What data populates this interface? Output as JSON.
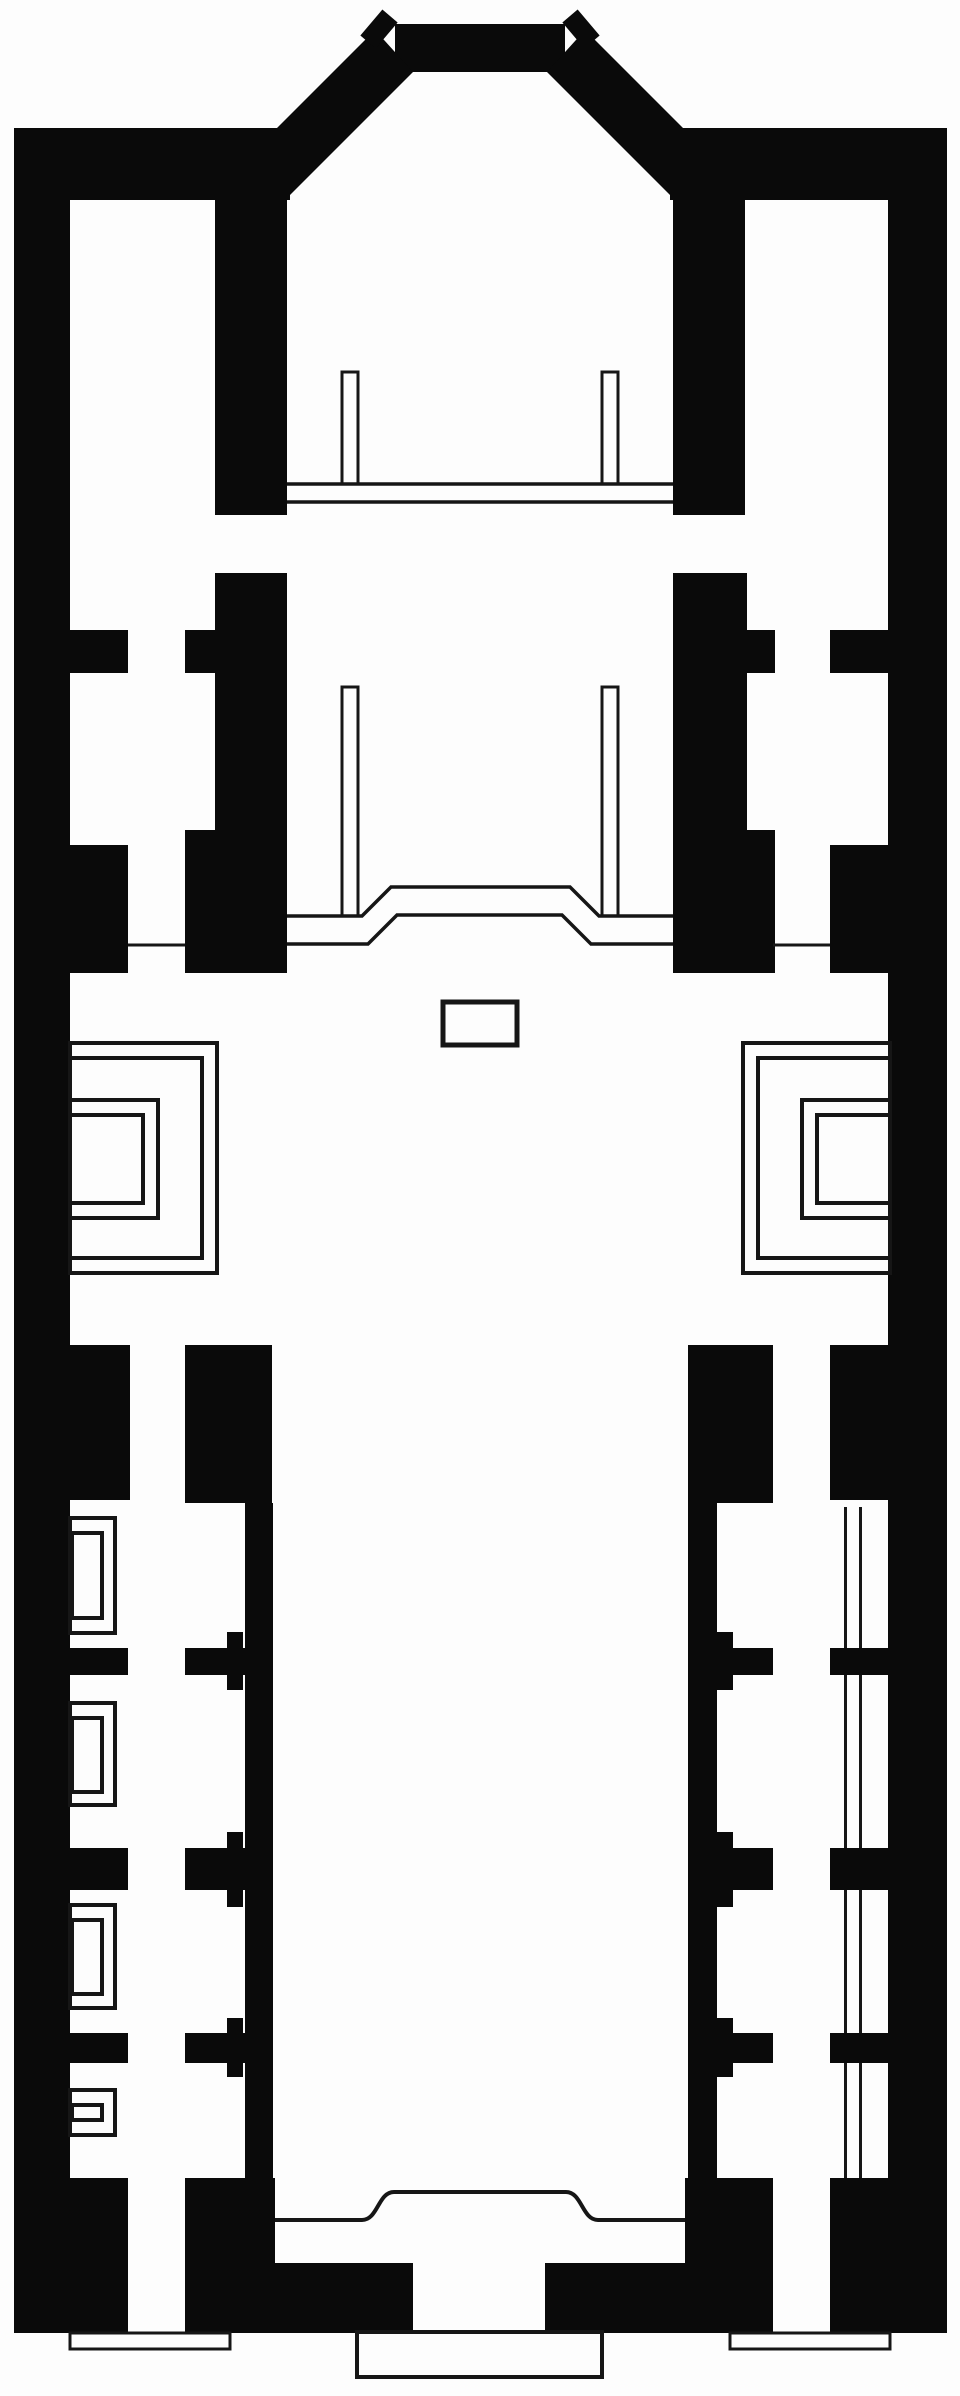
{
  "meta": {
    "description": "church-floor-plan",
    "canvas": {
      "width": 960,
      "height": 2396
    }
  },
  "palette": {
    "paper": "#fdfdfd",
    "ink": "#0a0a0a",
    "line": "#161616"
  },
  "plan": {
    "walls": [
      {
        "name": "outer-wall-left",
        "x": 14,
        "y": 128,
        "w": 56,
        "h": 2205
      },
      {
        "name": "outer-wall-right",
        "x": 888,
        "y": 128,
        "w": 59,
        "h": 2050
      },
      {
        "name": "apse-side-band-left",
        "x": 14,
        "y": 128,
        "w": 276,
        "h": 72
      },
      {
        "name": "apse-side-band-right",
        "x": 670,
        "y": 128,
        "w": 277,
        "h": 72
      },
      {
        "name": "apse-top-bar",
        "x": 395,
        "y": 24,
        "w": 170,
        "h": 48
      },
      {
        "name": "chancel-wall-left",
        "x": 215,
        "y": 200,
        "w": 72,
        "h": 315
      },
      {
        "name": "chancel-wall-right",
        "x": 673,
        "y": 200,
        "w": 72,
        "h": 315
      },
      {
        "name": "choir-wall-left",
        "x": 215,
        "y": 573,
        "w": 72,
        "h": 400
      },
      {
        "name": "choir-wall-right",
        "x": 673,
        "y": 573,
        "w": 74,
        "h": 400
      },
      {
        "name": "choir-spur-left-upper",
        "x": 185,
        "y": 630,
        "w": 30,
        "h": 43
      },
      {
        "name": "choir-spur-left-lower",
        "x": 185,
        "y": 830,
        "w": 30,
        "h": 143
      },
      {
        "name": "choir-spur-right-upper",
        "x": 747,
        "y": 630,
        "w": 28,
        "h": 43
      },
      {
        "name": "choir-spur-right-lower",
        "x": 747,
        "y": 830,
        "w": 28,
        "h": 143
      },
      {
        "name": "aisle-stub-left-upper",
        "x": 70,
        "y": 630,
        "w": 58,
        "h": 43
      },
      {
        "name": "aisle-block-left",
        "x": 70,
        "y": 845,
        "w": 58,
        "h": 128
      },
      {
        "name": "aisle-stub-right-upper",
        "x": 830,
        "y": 630,
        "w": 58,
        "h": 43
      },
      {
        "name": "aisle-block-right",
        "x": 830,
        "y": 845,
        "w": 58,
        "h": 128
      },
      {
        "name": "crossing-pier-left-outer",
        "x": 70,
        "y": 1345,
        "w": 60,
        "h": 155
      },
      {
        "name": "crossing-pier-left-inner",
        "x": 185,
        "y": 1345,
        "w": 87,
        "h": 158
      },
      {
        "name": "crossing-pier-right-inner",
        "x": 688,
        "y": 1345,
        "w": 85,
        "h": 158
      },
      {
        "name": "crossing-pier-right-outer",
        "x": 830,
        "y": 1345,
        "w": 58,
        "h": 155
      },
      {
        "name": "nave-wall-left",
        "x": 245,
        "y": 1503,
        "w": 28,
        "h": 675
      },
      {
        "name": "nave-wall-right",
        "x": 688,
        "y": 1503,
        "w": 29,
        "h": 675
      },
      {
        "name": "nave-stub-left-1",
        "x": 185,
        "y": 1648,
        "w": 88,
        "h": 27
      },
      {
        "name": "nave-stub-left-2",
        "x": 185,
        "y": 1848,
        "w": 88,
        "h": 42
      },
      {
        "name": "nave-stub-left-3",
        "x": 185,
        "y": 2033,
        "w": 88,
        "h": 30
      },
      {
        "name": "nave-notch-left-1a",
        "x": 227,
        "y": 1632,
        "w": 16,
        "h": 16
      },
      {
        "name": "nave-notch-left-1b",
        "x": 227,
        "y": 1675,
        "w": 16,
        "h": 15
      },
      {
        "name": "nave-notch-left-2a",
        "x": 227,
        "y": 1832,
        "w": 16,
        "h": 16
      },
      {
        "name": "nave-notch-left-2b",
        "x": 227,
        "y": 1890,
        "w": 16,
        "h": 17
      },
      {
        "name": "nave-notch-left-3a",
        "x": 227,
        "y": 2018,
        "w": 16,
        "h": 15
      },
      {
        "name": "nave-notch-left-3b",
        "x": 227,
        "y": 2063,
        "w": 16,
        "h": 14
      },
      {
        "name": "nave-stub-right-1",
        "x": 688,
        "y": 1648,
        "w": 85,
        "h": 27
      },
      {
        "name": "nave-stub-right-2",
        "x": 688,
        "y": 1848,
        "w": 85,
        "h": 42
      },
      {
        "name": "nave-stub-right-3",
        "x": 688,
        "y": 2033,
        "w": 85,
        "h": 30
      },
      {
        "name": "nave-notch-right-1a",
        "x": 717,
        "y": 1632,
        "w": 16,
        "h": 16
      },
      {
        "name": "nave-notch-right-1b",
        "x": 717,
        "y": 1675,
        "w": 16,
        "h": 15
      },
      {
        "name": "nave-notch-right-2a",
        "x": 717,
        "y": 1832,
        "w": 16,
        "h": 16
      },
      {
        "name": "nave-notch-right-2b",
        "x": 717,
        "y": 1890,
        "w": 16,
        "h": 17
      },
      {
        "name": "nave-notch-right-3a",
        "x": 717,
        "y": 2018,
        "w": 16,
        "h": 15
      },
      {
        "name": "nave-notch-right-3b",
        "x": 717,
        "y": 2063,
        "w": 16,
        "h": 14
      },
      {
        "name": "aisle-stub-left-1",
        "x": 70,
        "y": 1648,
        "w": 58,
        "h": 27
      },
      {
        "name": "aisle-stub-left-2",
        "x": 70,
        "y": 1848,
        "w": 58,
        "h": 42
      },
      {
        "name": "aisle-stub-left-3",
        "x": 70,
        "y": 2033,
        "w": 58,
        "h": 30
      },
      {
        "name": "aisle-stub-right-1",
        "x": 830,
        "y": 1648,
        "w": 58,
        "h": 27
      },
      {
        "name": "aisle-stub-right-2",
        "x": 830,
        "y": 1848,
        "w": 58,
        "h": 42
      },
      {
        "name": "aisle-stub-right-3",
        "x": 830,
        "y": 2033,
        "w": 58,
        "h": 30
      },
      {
        "name": "entrance-block-left",
        "x": 70,
        "y": 2178,
        "w": 58,
        "h": 155
      },
      {
        "name": "entrance-pier-left",
        "x": 185,
        "y": 2178,
        "w": 90,
        "h": 155
      },
      {
        "name": "entrance-pier-right",
        "x": 685,
        "y": 2178,
        "w": 88,
        "h": 155
      },
      {
        "name": "entrance-block-right",
        "x": 830,
        "y": 2178,
        "w": 117,
        "h": 155
      },
      {
        "name": "facade-wall-left",
        "x": 275,
        "y": 2263,
        "w": 138,
        "h": 70
      },
      {
        "name": "facade-wall-right",
        "x": 545,
        "y": 2263,
        "w": 140,
        "h": 70
      }
    ],
    "diagonal_polygons": [
      {
        "name": "apse-diagonal-left",
        "points": "375,30 413,72 285,200 205,200"
      },
      {
        "name": "apse-diagonal-right",
        "points": "585,30 547,72 675,200 755,200"
      }
    ],
    "tick_lines": [
      {
        "name": "apse-corner-tick-left",
        "x1": 368,
        "y1": 42,
        "x2": 390,
        "y2": 16,
        "w": 20
      },
      {
        "name": "apse-corner-tick-right",
        "x1": 592,
        "y1": 42,
        "x2": 570,
        "y2": 16,
        "w": 20
      }
    ],
    "outlines": [
      {
        "name": "crossing-niche-left-rect-1",
        "x": 70,
        "y": 1043,
        "w": 147,
        "h": 230,
        "s": 4
      },
      {
        "name": "crossing-niche-left-rect-2",
        "x": 70,
        "y": 1058,
        "w": 132,
        "h": 200,
        "s": 4
      },
      {
        "name": "crossing-niche-left-rect-3",
        "x": 70,
        "y": 1100,
        "w": 88,
        "h": 118,
        "s": 4
      },
      {
        "name": "crossing-niche-left-rect-4",
        "x": 70,
        "y": 1115,
        "w": 73,
        "h": 88,
        "s": 4
      },
      {
        "name": "crossing-niche-right-rect-1",
        "x": 743,
        "y": 1043,
        "w": 147,
        "h": 230,
        "s": 4
      },
      {
        "name": "crossing-niche-right-rect-2",
        "x": 758,
        "y": 1058,
        "w": 132,
        "h": 200,
        "s": 4
      },
      {
        "name": "crossing-niche-right-rect-3",
        "x": 802,
        "y": 1100,
        "w": 88,
        "h": 118,
        "s": 4
      },
      {
        "name": "crossing-niche-right-rect-4",
        "x": 817,
        "y": 1115,
        "w": 73,
        "h": 88,
        "s": 4
      },
      {
        "name": "side-niche-1-outer",
        "x": 70,
        "y": 1518,
        "w": 45,
        "h": 115,
        "s": 4
      },
      {
        "name": "side-niche-1-inner",
        "x": 72,
        "y": 1533,
        "w": 30,
        "h": 85,
        "s": 4
      },
      {
        "name": "side-niche-2-outer",
        "x": 70,
        "y": 1703,
        "w": 45,
        "h": 102,
        "s": 4
      },
      {
        "name": "side-niche-2-inner",
        "x": 72,
        "y": 1718,
        "w": 30,
        "h": 74,
        "s": 4
      },
      {
        "name": "side-niche-3-outer",
        "x": 70,
        "y": 1905,
        "w": 45,
        "h": 103,
        "s": 4
      },
      {
        "name": "side-niche-3-inner",
        "x": 72,
        "y": 1920,
        "w": 30,
        "h": 74,
        "s": 4
      },
      {
        "name": "side-niche-4-outer",
        "x": 70,
        "y": 2090,
        "w": 45,
        "h": 45,
        "s": 4
      },
      {
        "name": "side-niche-4-inner",
        "x": 72,
        "y": 2105,
        "w": 30,
        "h": 15,
        "s": 4
      },
      {
        "name": "apse-column-left",
        "x": 342,
        "y": 372,
        "w": 16,
        "h": 112,
        "s": 3
      },
      {
        "name": "apse-column-right",
        "x": 602,
        "y": 372,
        "w": 16,
        "h": 112,
        "s": 3
      },
      {
        "name": "choir-column-left",
        "x": 342,
        "y": 687,
        "w": 16,
        "h": 229,
        "s": 3
      },
      {
        "name": "choir-column-right",
        "x": 602,
        "y": 687,
        "w": 16,
        "h": 229,
        "s": 3
      },
      {
        "name": "altar-box",
        "x": 443,
        "y": 1002,
        "w": 74,
        "h": 43,
        "s": 5
      },
      {
        "name": "front-step-platform",
        "x": 357,
        "y": 2332,
        "w": 245,
        "h": 45,
        "s": 4
      },
      {
        "name": "side-step-left",
        "x": 70,
        "y": 2333,
        "w": 160,
        "h": 16,
        "s": 3
      },
      {
        "name": "side-step-right",
        "x": 730,
        "y": 2333,
        "w": 160,
        "h": 16,
        "s": 3
      }
    ],
    "polylines": [
      {
        "name": "altar-rail-line-upper",
        "points": "287,484 673,484",
        "s": 3.5
      },
      {
        "name": "altar-rail-line-lower",
        "points": "287,502 673,502",
        "s": 3.5
      },
      {
        "name": "choir-step-upper",
        "points": "287,916 362,916 391,887 570,887 599,916 673,916",
        "s": 3.5
      },
      {
        "name": "choir-step-lower",
        "points": "287,944 368,944 397,915 562,915 591,944 673,944",
        "s": 3.5
      },
      {
        "name": "aisle-step-line-left",
        "points": "128,945 185,945",
        "s": 3
      },
      {
        "name": "aisle-step-line-right",
        "points": "773,945 830,945",
        "s": 3
      }
    ],
    "paths": [
      {
        "name": "narthex-inner-line",
        "d": "M275,2220 L362,2220 C378,2220 378,2192 394,2192 L566,2192 C582,2192 582,2220 598,2220 L685,2220",
        "s": 4
      }
    ],
    "screen_lines": [
      {
        "name": "aisle-screen-right-line-1",
        "x1": 845.5,
        "y1": 1507,
        "x2": 845.5,
        "y2": 2178,
        "w": 3
      },
      {
        "name": "aisle-screen-right-line-2",
        "x1": 860.5,
        "y1": 1507,
        "x2": 860.5,
        "y2": 2178,
        "w": 3
      }
    ]
  }
}
